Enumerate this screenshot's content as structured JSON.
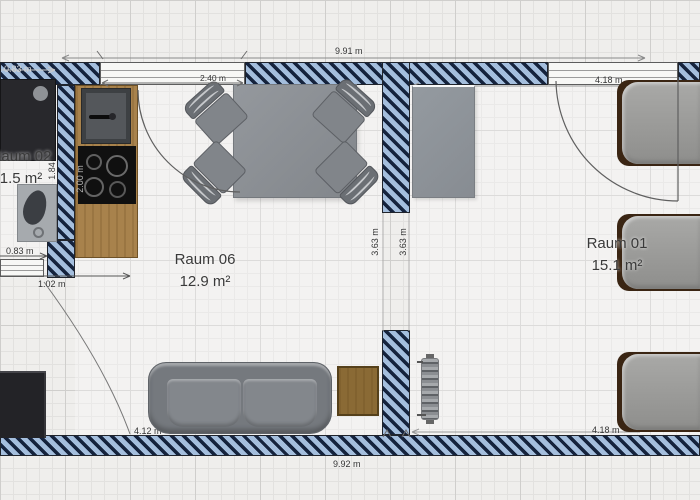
{
  "rooms": {
    "raum02": {
      "name": "Raum 02",
      "area": "1.5 m²"
    },
    "raum06": {
      "name": "Raum 06",
      "area": "12.9 m²"
    },
    "raum01": {
      "name": "Raum 01",
      "area": "15.1 m²"
    }
  },
  "dimensions": {
    "top_width": "9.91 m",
    "bottom_width": "9.92 m",
    "window_width": "2.40 m",
    "bath_width_top": "0.83 m",
    "bath_width_mid": "0.83 m",
    "bath_door_width": "1.02 m",
    "bath_height": "1.84",
    "kitchen_length": "2.00 m",
    "passage_left": "3.63 m",
    "passage_right": "3.63 m",
    "room1_width_top": "4.18 m",
    "room1_width_bottom": "4.18 m",
    "sofa_wall_width": "4.12 m"
  },
  "colors": {
    "wall_fill": "#a4bedd",
    "wall_stripe": "#15233d",
    "wood": "#a8824c",
    "furniture_gray": "#85898e",
    "bed_frame_brown": "#3a2513",
    "floor": "#efeeec"
  }
}
